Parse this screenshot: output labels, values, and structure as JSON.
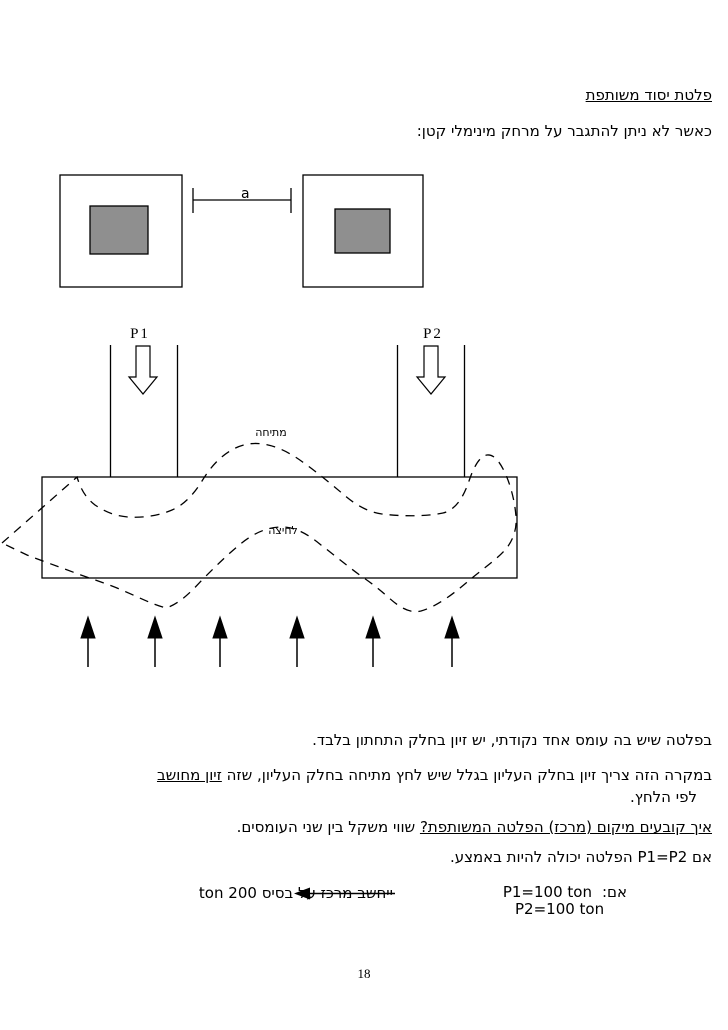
{
  "document": {
    "title": "פלטת יסוד משותפת",
    "intro": "כאשר לא ניתן להתגבר על מרחק מינימלי קטן:",
    "page_number": "18"
  },
  "figure_spacing": {
    "dimension_label": "a"
  },
  "figure_combined": {
    "load1_label": "P1",
    "load2_label": "P2",
    "tension_label": "מתיחה",
    "compression_label": "לחיצה"
  },
  "body": {
    "single_load_note": "בפלטה שיש בה עומס אחד נקודתי, יש זיון בחלק התחתון בלבד.",
    "top_reinforcement_note": "במקרה הזה צריך זיון בחלק העליון בגלל שיש לחץ מתיחה בחלק העליון, שזה ",
    "top_reinforcement_underlined": "זיון מחושב",
    "top_reinforcement_cont": "לפי הלחץ.",
    "location_question": "איך קובעים מיקום (מרכז) הפלטה המשותפת?",
    "location_answer": " שווי משקל בין שני העומסים.",
    "equal_loads_note": "אם P1=P2 הפלטה יכולה להיות באמצע.",
    "example": {
      "if_label": "אם:",
      "p1_value": "P1=100 ton",
      "p2_value": "P2=100 ton",
      "center_note_part1": "ייחשב מרכז ",
      "center_note_part2": "על בסיס 200 ton"
    }
  },
  "colors": {
    "footing_fill": "#8f8f8f",
    "line": "#000000"
  }
}
